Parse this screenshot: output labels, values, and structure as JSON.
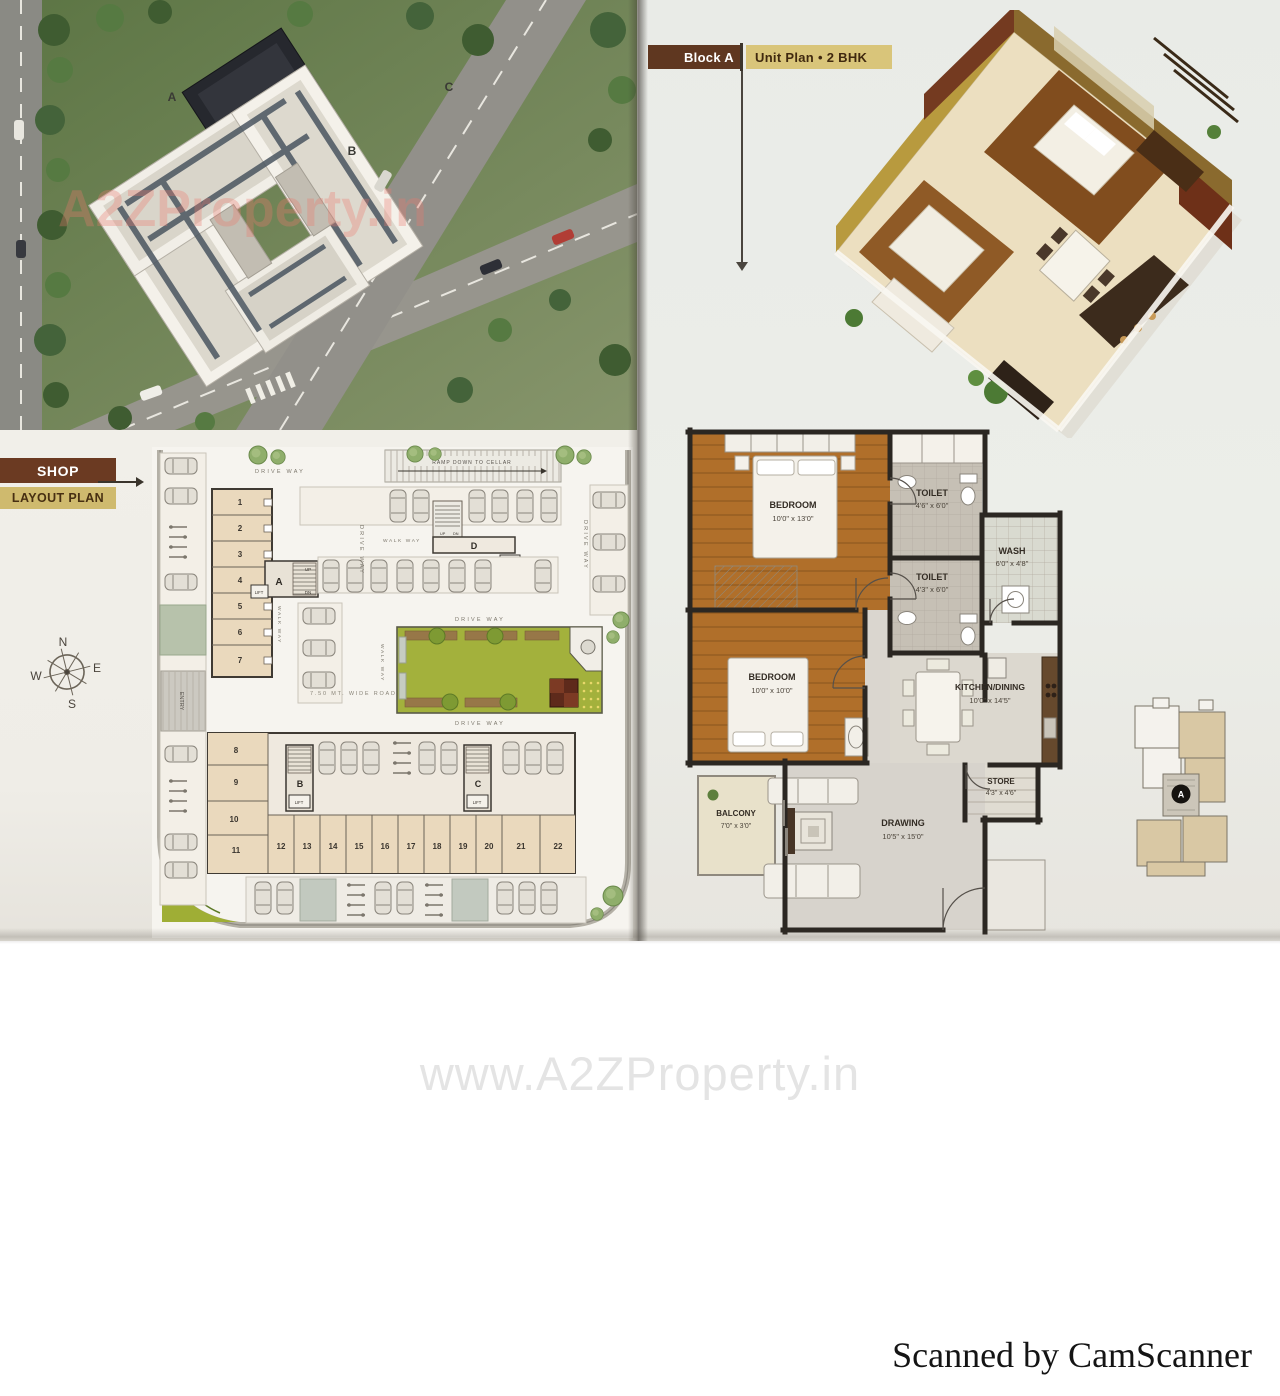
{
  "page": {
    "watermark": "www.A2ZProperty.in",
    "footer": "Scanned by CamScanner"
  },
  "photo": {
    "watermark": "A2ZProperty.in",
    "building_a": "A",
    "building_b": "B",
    "building_c": "C"
  },
  "unit_plan": {
    "block_label": "Block A",
    "title": "Unit Plan • 2 BHK"
  },
  "shop_layout": {
    "line1": "SHOP",
    "line2": "LAYOUT PLAN"
  },
  "compass": {
    "n": "N",
    "e": "E",
    "s": "S",
    "w": "W"
  },
  "site_plan": {
    "drive_way": "DRIVE WAY",
    "walk_way": "WALK WAY",
    "ramp": "RAMP DOWN TO CELLAR",
    "road": "7.50 MT. WIDE ROAD",
    "entry": "ENTRY",
    "lift": "LIFT",
    "up": "UP",
    "dn": "DN",
    "block_a": "A",
    "block_b": "B",
    "block_c": "C",
    "block_d": "D",
    "shops": [
      "1",
      "2",
      "3",
      "4",
      "5",
      "6",
      "7",
      "8",
      "9",
      "10",
      "11",
      "12",
      "13",
      "14",
      "15",
      "16",
      "17",
      "18",
      "19",
      "20",
      "21",
      "22"
    ]
  },
  "floor_plan": {
    "rooms": [
      {
        "name": "BEDROOM",
        "dims": "10'0\" x 13'0\""
      },
      {
        "name": "TOILET",
        "dims": "4'6\" x 6'0\""
      },
      {
        "name": "TOILET",
        "dims": "4'3\" x 6'0\""
      },
      {
        "name": "WASH",
        "dims": "6'0\" x 4'8\""
      },
      {
        "name": "BEDROOM",
        "dims": "10'0\" x 10'0\""
      },
      {
        "name": "KITCHEN/DINING",
        "dims": "10'0\" x 14'5\""
      },
      {
        "name": "STORE",
        "dims": "4'3\" x 4'6\""
      },
      {
        "name": "BALCONY",
        "dims": "7'0\" x 3'0\""
      },
      {
        "name": "DRAWING",
        "dims": "10'5\" x 15'0\""
      }
    ]
  },
  "key_plan": {
    "block_label": "A"
  },
  "colors": {
    "header_brown": "#5f3720",
    "header_tan": "#d9c57a",
    "band_brown": "#6b3a22",
    "band_tan": "#cfba6e",
    "shop_fill": "#ead9bd",
    "garden_green": "#a3b13c",
    "wood_floor": "#b06f2a",
    "page_bg": "#ebe9e4"
  }
}
